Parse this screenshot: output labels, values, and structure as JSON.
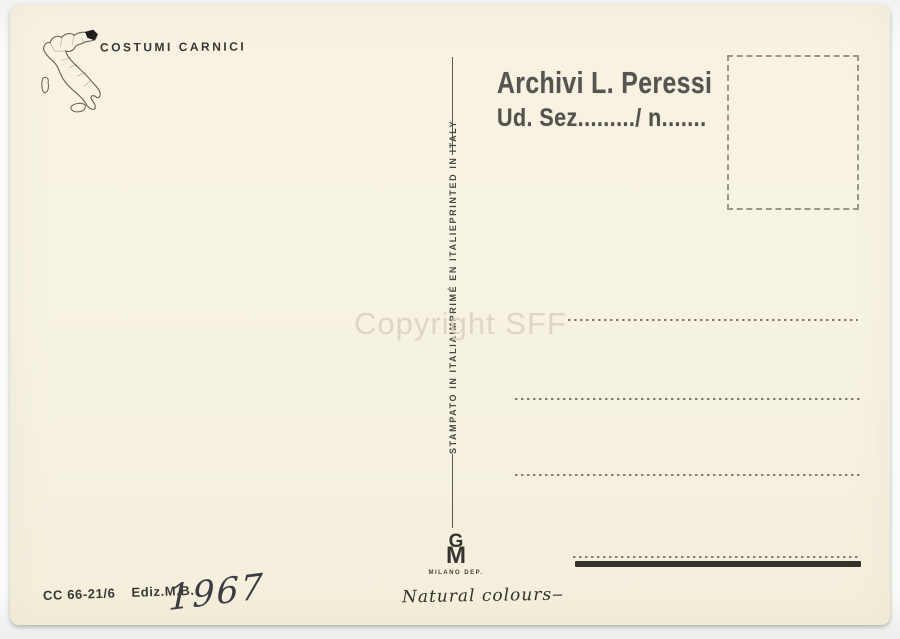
{
  "card": {
    "title": "COSTUMI CARNICI",
    "divider_text": {
      "it": "STAMPATO IN ITALIA",
      "fr": "IMPRIMÉ EN ITALIE",
      "en": "PRINTED IN ITALY"
    },
    "archive_stamp": {
      "line1": "Archivi L. Peressi",
      "line2": "Ud. Sez........./ n......."
    },
    "watermark": "Copyright SFF",
    "footer": {
      "code": "CC 66-21/6",
      "edition": "Ediz.M.B.",
      "handwritten_year": "1967"
    },
    "publisher_logo": {
      "monogram_g": "G",
      "monogram_m": "M",
      "city": "MILANO DEP.",
      "script": "Natural colours",
      "script_flourish": "‒"
    },
    "colors": {
      "paper": "#f7f2e2",
      "ink": "#3a3834",
      "stamp_ink": "#4a4743",
      "dots": "#837d6e",
      "watermark": "#d9d2c0"
    }
  }
}
